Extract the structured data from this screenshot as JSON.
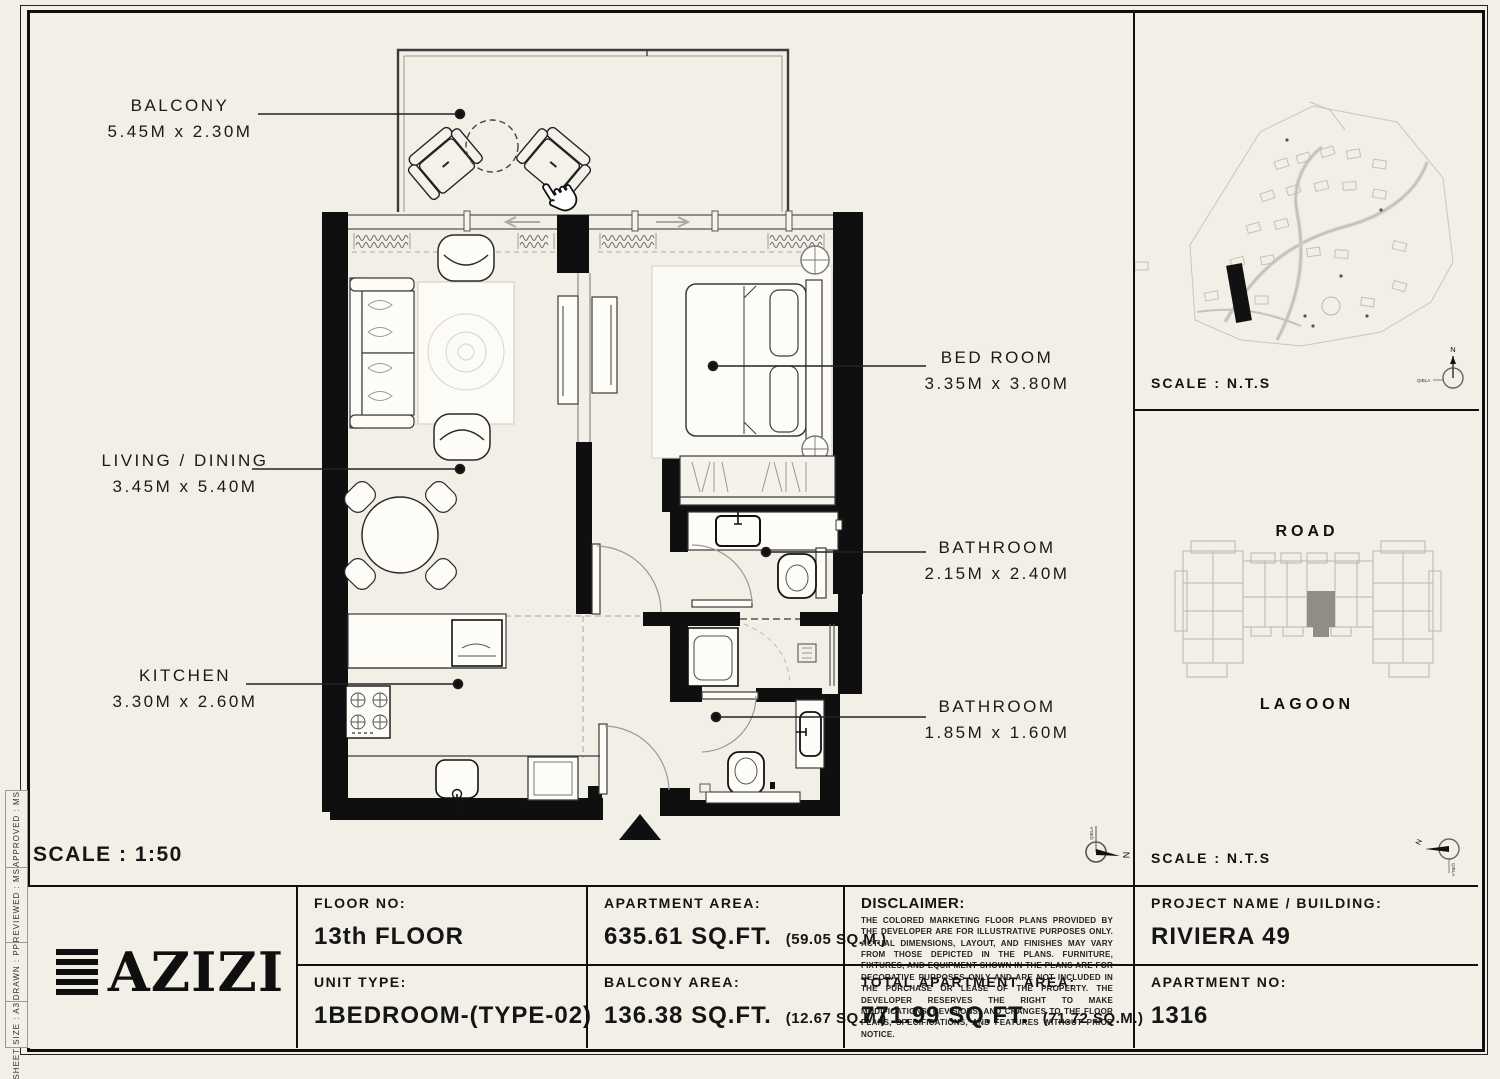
{
  "sheet": {
    "scale_main": "SCALE : 1:50",
    "scale_nts": "SCALE : N.T.S"
  },
  "sidebar": {
    "items": [
      "APPROVED :  MS",
      "REVIEWED :  MS",
      "DRAWN :  PP",
      "SHEET SIZE : A3"
    ]
  },
  "floor_plan": {
    "rooms": [
      {
        "name": "BALCONY",
        "dims": "5.45M x 2.30M"
      },
      {
        "name": "LIVING / DINING",
        "dims": "3.45M x 5.40M"
      },
      {
        "name": "KITCHEN",
        "dims": "3.30M x 2.60M"
      },
      {
        "name": "BED ROOM",
        "dims": "3.35M x 3.80M"
      },
      {
        "name": "BATHROOM",
        "dims": "2.15M x 2.40M"
      },
      {
        "name": "BATHROOM",
        "dims": "1.85M x 1.60M"
      }
    ]
  },
  "site_map_panel": {
    "scale_label": "SCALE : N.T.S"
  },
  "key_plan_panel": {
    "road_label": "ROAD",
    "lagoon_label": "LAGOON",
    "scale_label": "SCALE : N.T.S"
  },
  "compass": {
    "north": "N",
    "qibla": "QIBLA"
  },
  "title_block": {
    "brand": "AZIZI",
    "floor_no_label": "FLOOR NO:",
    "floor_no": "13th FLOOR",
    "unit_type_label": "UNIT TYPE:",
    "unit_type": "1BEDROOM-(TYPE-02)",
    "apartment_area_label": "APARTMENT AREA:",
    "apartment_area_value": "635.61 SQ.FT.",
    "apartment_area_metric": "(59.05 SQ.M.)",
    "balcony_area_label": "BALCONY AREA:",
    "balcony_area_value": "136.38 SQ.FT.",
    "balcony_area_metric": "(12.67 SQ.M.)",
    "disclaimer_label": "DISCLAIMER:",
    "disclaimer_text": "THE COLORED MARKETING FLOOR PLANS PROVIDED BY THE DEVELOPER ARE FOR ILLUSTRATIVE PURPOSES ONLY. ACTUAL DIMENSIONS, LAYOUT, AND FINISHES MAY VARY FROM THOSE DEPICTED IN THE PLANS. FURNITURE, FIXTURES, AND EQUIPMENT SHOWN IN THE PLANS ARE FOR DECORATIVE PURPOSES ONLY AND ARE NOT INCLUDED IN THE PURCHASE OR LEASE OF THE PROPERTY. THE DEVELOPER RESERVES THE RIGHT TO MAKE MODIFICATIONS, REVISIONS, AND CHANGES TO THE FLOOR PLANS, SPECIFICATIONS, AND FEATURES WITHOUT PRIOR NOTICE.",
    "total_area_label": "TOTAL APARTMENT AREA:",
    "total_area_value": "771.99 SQ.FT.",
    "total_area_metric": "(71.72 SQ.M.)",
    "project_label": "PROJECT NAME / BUILDING:",
    "project_name": "RIVIERA  49",
    "apartment_no_label": "APARTMENT NO:",
    "apartment_no": "1316"
  }
}
